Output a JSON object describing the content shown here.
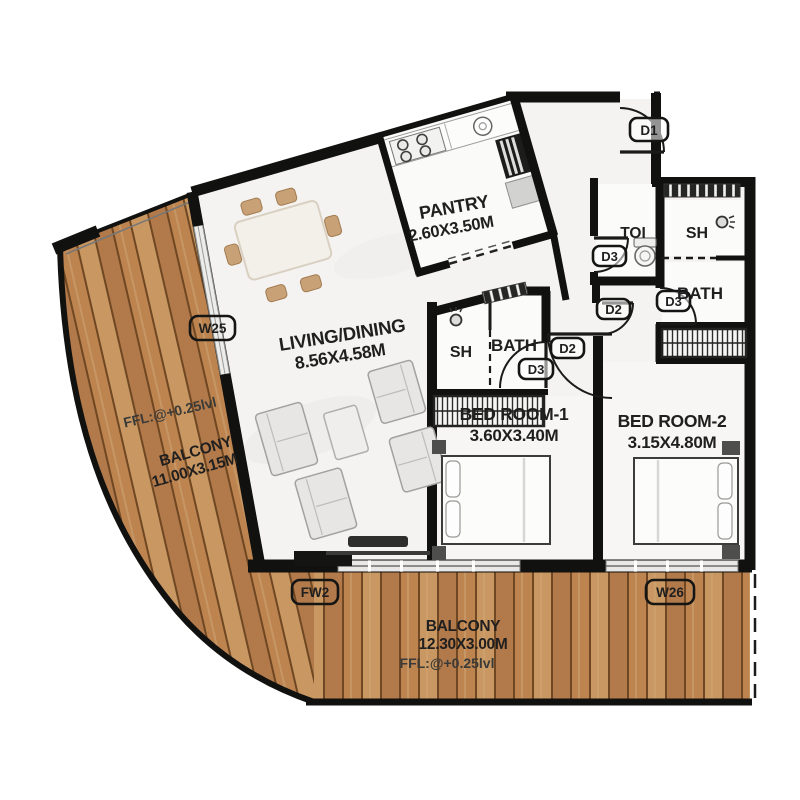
{
  "rooms": {
    "living": {
      "label": "LIVING/DINING",
      "dims": "8.56X4.58M"
    },
    "pantry": {
      "label": "PANTRY",
      "dims": "2.60X3.50M"
    },
    "bed1": {
      "label": "BED ROOM-1",
      "dims": "3.60X3.40M"
    },
    "bed2": {
      "label": "BED ROOM-2",
      "dims": "3.15X4.80M"
    },
    "balcony_left": {
      "label": "BALCONY",
      "dims": "11.00X3.15M",
      "ffl": "FFL:@+0.25lvl"
    },
    "balcony_bottom": {
      "label": "BALCONY",
      "dims": "12.30X3.00M",
      "ffl": "FFL:@+0.25lvl"
    },
    "toi": {
      "label": "TOI"
    },
    "sh_top": {
      "label": "SH"
    },
    "bath_top": {
      "label": "BATH"
    },
    "sh_mid": {
      "label": "SH"
    },
    "bath_mid": {
      "label": "BATH"
    }
  },
  "doors": {
    "d1": "D1",
    "d2": "D2",
    "d3": "D3"
  },
  "windows": {
    "w25": "W25",
    "w26": "W26",
    "fw2": "FW2"
  },
  "colors": {
    "wall": "#111110",
    "wood_base": "#c08a55",
    "wood_gap": "#6f4722",
    "floor": "#f4f3f1",
    "label_text": "#1f1f1f"
  }
}
